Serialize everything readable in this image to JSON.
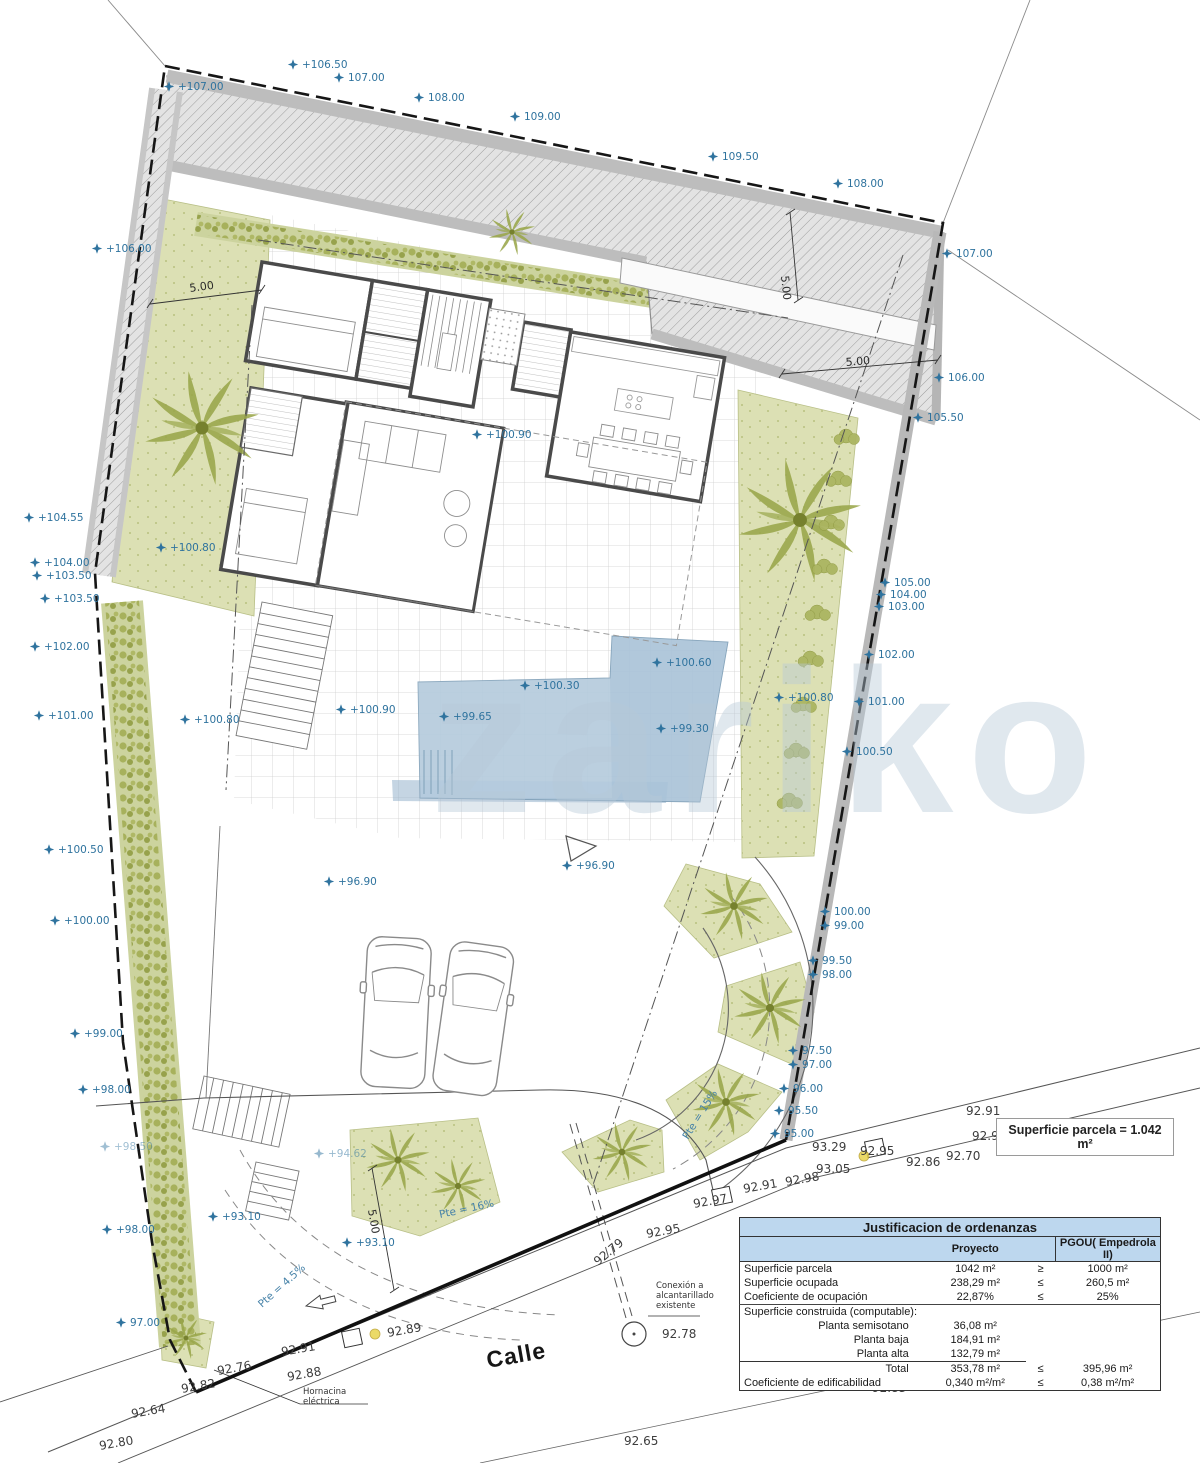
{
  "drawing": {
    "street_label": "Calle",
    "watermark": "zariko",
    "parcel_badge": "Superficie parcela = 1.042 m²",
    "labels_blue": [
      {
        "t": "+107.00",
        "x": 178,
        "y": 90
      },
      {
        "t": "+106.50",
        "x": 302,
        "y": 68
      },
      {
        "t": "107.00",
        "x": 348,
        "y": 81
      },
      {
        "t": "108.00",
        "x": 428,
        "y": 101
      },
      {
        "t": "109.00",
        "x": 524,
        "y": 120
      },
      {
        "t": "109.50",
        "x": 722,
        "y": 160
      },
      {
        "t": "108.00",
        "x": 847,
        "y": 187
      },
      {
        "t": "107.00",
        "x": 956,
        "y": 257
      },
      {
        "t": "106.00",
        "x": 948,
        "y": 381
      },
      {
        "t": "105.50",
        "x": 927,
        "y": 421
      },
      {
        "t": "+106.00",
        "x": 106,
        "y": 252
      },
      {
        "t": "+104.55",
        "x": 38,
        "y": 521
      },
      {
        "t": "+104.00",
        "x": 44,
        "y": 566
      },
      {
        "t": "+103.50",
        "x": 46,
        "y": 579
      },
      {
        "t": "+103.50",
        "x": 54,
        "y": 602
      },
      {
        "t": "+102.00",
        "x": 44,
        "y": 650
      },
      {
        "t": "+101.00",
        "x": 48,
        "y": 719
      },
      {
        "t": "+100.50",
        "x": 58,
        "y": 853
      },
      {
        "t": "+100.00",
        "x": 64,
        "y": 924
      },
      {
        "t": "+99.00",
        "x": 84,
        "y": 1037
      },
      {
        "t": "+98.00",
        "x": 92,
        "y": 1093
      },
      {
        "t": "+98.50",
        "x": 114,
        "y": 1150,
        "o": 0.45
      },
      {
        "t": "+98.00",
        "x": 116,
        "y": 1233
      },
      {
        "t": "97.00",
        "x": 130,
        "y": 1326
      },
      {
        "t": "105.00",
        "x": 894,
        "y": 586
      },
      {
        "t": "104.00",
        "x": 890,
        "y": 598
      },
      {
        "t": "103.00",
        "x": 888,
        "y": 610
      },
      {
        "t": "102.00",
        "x": 878,
        "y": 658
      },
      {
        "t": "101.00",
        "x": 868,
        "y": 705
      },
      {
        "t": "100.50",
        "x": 856,
        "y": 755
      },
      {
        "t": "100.00",
        "x": 834,
        "y": 915
      },
      {
        "t": "99.00",
        "x": 834,
        "y": 929
      },
      {
        "t": "99.50",
        "x": 822,
        "y": 964
      },
      {
        "t": "98.00",
        "x": 822,
        "y": 978
      },
      {
        "t": "97.50",
        "x": 802,
        "y": 1054
      },
      {
        "t": "97.00",
        "x": 802,
        "y": 1068
      },
      {
        "t": "96.00",
        "x": 793,
        "y": 1092
      },
      {
        "t": "95.50",
        "x": 788,
        "y": 1114
      },
      {
        "t": "95.00",
        "x": 784,
        "y": 1137
      },
      {
        "t": "+100.80",
        "x": 170,
        "y": 551
      },
      {
        "t": "+100.80",
        "x": 194,
        "y": 723
      },
      {
        "t": "+100.90",
        "x": 486,
        "y": 438
      },
      {
        "t": "+100.60",
        "x": 666,
        "y": 666
      },
      {
        "t": "+100.30",
        "x": 534,
        "y": 689
      },
      {
        "t": "+100.90",
        "x": 350,
        "y": 713
      },
      {
        "t": "+99.65",
        "x": 453,
        "y": 720
      },
      {
        "t": "+99.30",
        "x": 670,
        "y": 732
      },
      {
        "t": "+100.80",
        "x": 788,
        "y": 701
      },
      {
        "t": "+96.90",
        "x": 338,
        "y": 885
      },
      {
        "t": "+96.90",
        "x": 576,
        "y": 869
      },
      {
        "t": "+93.10",
        "x": 222,
        "y": 1220
      },
      {
        "t": "+93.10",
        "x": 356,
        "y": 1246
      },
      {
        "t": "+94.62",
        "x": 328,
        "y": 1157,
        "o": 0.5
      }
    ],
    "labels_dark": [
      {
        "t": "92.91",
        "x": 744,
        "y": 1193,
        "r": -10
      },
      {
        "t": "92.97",
        "x": 694,
        "y": 1208,
        "r": -10
      },
      {
        "t": "92.95",
        "x": 647,
        "y": 1238,
        "r": -10
      },
      {
        "t": "93.29",
        "x": 812,
        "y": 1151
      },
      {
        "t": "93.05",
        "x": 816,
        "y": 1173
      },
      {
        "t": "92.98",
        "x": 786,
        "y": 1186,
        "r": -10
      },
      {
        "t": "92.91",
        "x": 966,
        "y": 1115
      },
      {
        "t": "92.90",
        "x": 972,
        "y": 1140
      },
      {
        "t": "92.95",
        "x": 860,
        "y": 1155
      },
      {
        "t": "92.86",
        "x": 906,
        "y": 1166
      },
      {
        "t": "92.70",
        "x": 946,
        "y": 1160
      },
      {
        "t": "92.89",
        "x": 388,
        "y": 1337,
        "r": -10
      },
      {
        "t": "92.91",
        "x": 282,
        "y": 1356,
        "r": -10
      },
      {
        "t": "92.88",
        "x": 288,
        "y": 1381,
        "r": -10
      },
      {
        "t": "92.76",
        "x": 218,
        "y": 1375,
        "r": -10
      },
      {
        "t": "92.82",
        "x": 182,
        "y": 1393,
        "r": -10
      },
      {
        "t": "92.64",
        "x": 132,
        "y": 1418,
        "r": -10
      },
      {
        "t": "92.80",
        "x": 100,
        "y": 1450,
        "r": -10
      },
      {
        "t": "92.65",
        "x": 624,
        "y": 1445
      },
      {
        "t": "92.83",
        "x": 872,
        "y": 1392
      },
      {
        "t": "92.79",
        "x": 598,
        "y": 1266,
        "r": -40
      },
      {
        "t": "92.78",
        "x": 662,
        "y": 1338
      }
    ],
    "labels_dim": [
      {
        "t": "5.00",
        "x": 190,
        "y": 292,
        "r": -8
      },
      {
        "t": "5.00",
        "x": 846,
        "y": 366,
        "r": -5
      },
      {
        "t": "5.00",
        "x": 781,
        "y": 276,
        "r": 84
      },
      {
        "t": "5.00",
        "x": 368,
        "y": 1210,
        "r": 80
      }
    ],
    "labels_slope": [
      {
        "t": "Pte = 16%",
        "x": 440,
        "y": 1218,
        "r": -12
      },
      {
        "t": "Pte = 15%",
        "x": 688,
        "y": 1140,
        "r": -58
      },
      {
        "t": "Pte = 4.5%",
        "x": 262,
        "y": 1308,
        "r": -42
      }
    ],
    "notes": [
      {
        "lines": [
          "Hornacina",
          "eléctrica"
        ],
        "x": 303,
        "y": 1394
      },
      {
        "lines": [
          "Conexión a",
          "alcantarillado",
          "existente"
        ],
        "x": 656,
        "y": 1288
      }
    ]
  },
  "table": {
    "title": "Justificacion de ordenanzas",
    "col_project": "Proyecto",
    "col_pgou": "PGOU( Empedrola II)",
    "rows": [
      {
        "label": "Superficie parcela",
        "value": "1042 m²",
        "cmp": "≥",
        "pgou": "1000 m²"
      },
      {
        "label": "Superficie ocupada",
        "value": "238,29 m²",
        "cmp": "≤",
        "pgou": "260,5 m²"
      },
      {
        "label": "Coeficiente de ocupación",
        "value": "22,87%",
        "cmp": "≤",
        "pgou": "25%",
        "sep": true
      },
      {
        "label": "Superficie construida (computable):",
        "value": "",
        "cmp": "",
        "pgou": ""
      },
      {
        "label": "Planta semisotano",
        "value": "36,08 m²",
        "cmp": "",
        "pgou": "",
        "indent": true
      },
      {
        "label": "Planta baja",
        "value": "184,91 m²",
        "cmp": "",
        "pgou": "",
        "indent": true
      },
      {
        "label": "Planta alta",
        "value": "132,79 m²",
        "cmp": "",
        "pgou": "",
        "indent": true
      },
      {
        "label": "Total",
        "value": "353,78 m²",
        "cmp": "≤",
        "pgou": "395,96 m²",
        "indent": true,
        "total": true
      },
      {
        "label": "Coeficiente de edificabilidad",
        "value": "0,340 m²/m²",
        "cmp": "≤",
        "pgou": "0,38 m²/m²"
      }
    ]
  }
}
